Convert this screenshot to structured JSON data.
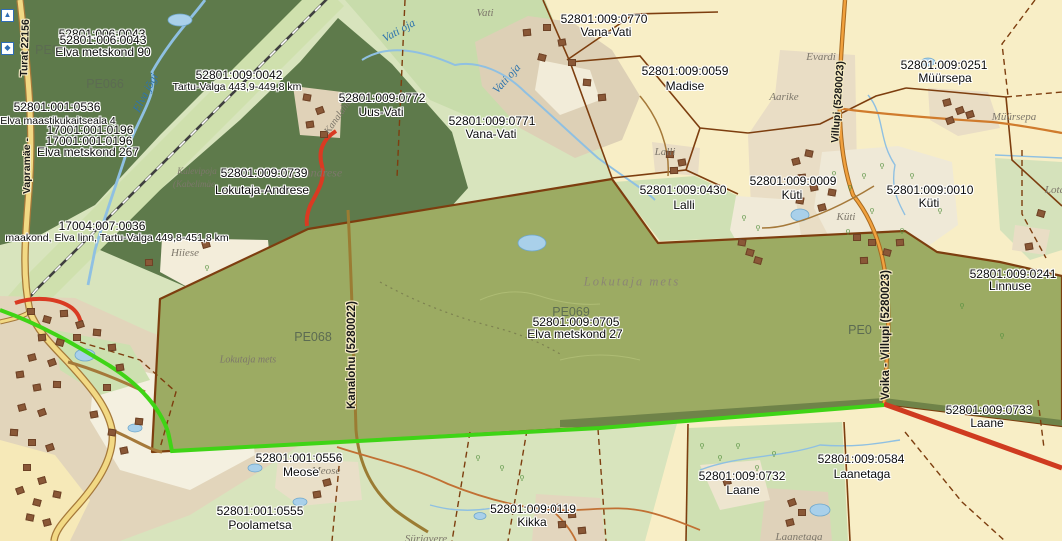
{
  "map_type": "cadastral-map-viewer",
  "colors": {
    "field_yellow": "#f8eec6",
    "grass_green": "#d8e4bd",
    "forest_dark": "#5e7a4b",
    "parcel_olive": "#9cab63",
    "boundary_brown": "#7d3e0f",
    "route_green": "#3fd416",
    "route_red": "#d93a22",
    "road_orange": "#f1a13e",
    "water_blue": "#8fc0e2"
  },
  "parcels": [
    {
      "code": "52801:006:0043",
      "name": "Elva metskond 90"
    },
    {
      "code": "52801:001:0536",
      "name": "Elva maastikukaitseala 4"
    },
    {
      "code": "17001:001:0196",
      "name": "Elva metskond 267"
    },
    {
      "code": "52801:009:0042",
      "name": "Tartu-Valga 443,9-449,8 km"
    },
    {
      "code": "17004:007:0036",
      "name": "maakond, Elva linn, Tartu-Valga 449,8-451,8 km"
    },
    {
      "code": "52801:009:0739",
      "name": "Lokutaja-Andrese"
    },
    {
      "code": "52801:009:0772",
      "name": "Uus-Vati"
    },
    {
      "code": "52801:009:0771",
      "name": "Vana-Vati"
    },
    {
      "code": "52801:009:0770",
      "name": "Vana-Vati"
    },
    {
      "code": "52801:009:0059",
      "name": "Madise"
    },
    {
      "code": "52801:009:0251",
      "name": "Müürsepa"
    },
    {
      "code": "52801:009:0430",
      "name": "Lalli"
    },
    {
      "code": "52801:009:0009",
      "name": "Küti"
    },
    {
      "code": "52801:009:0010",
      "name": "Küti"
    },
    {
      "code": "52801:009:0241",
      "name": "Linnuse"
    },
    {
      "code": "52801:009:0705",
      "name": "Elva metskond 27"
    },
    {
      "code": "52801:001:0556",
      "name": "Meose"
    },
    {
      "code": "52801:001:0555",
      "name": "Poolametsa"
    },
    {
      "code": "52801:009:0119",
      "name": "Kikka"
    },
    {
      "code": "52801:009:0733",
      "name": "Laane"
    },
    {
      "code": "52801:009:0584",
      "name": "Laanetaga"
    },
    {
      "code": "52801:009:0732",
      "name": "Laane"
    }
  ],
  "forest_codes": {
    "pe066": "PE066",
    "pe068": "PE068",
    "pe069": "PE069",
    "pe0_right": "PE0",
    "pe_topleft": "PE0"
  },
  "roads": {
    "kanalohu": "Kanalohu (5280022)",
    "voika_villupi": "Voika - Villupi (5280023)",
    "villupi_top": "Villupi (5280023)",
    "vapramae_lower": "Vapramäe -",
    "vapramae_upper": "Turat 22156"
  },
  "places": {
    "vati": "Vati",
    "evardi": "Evardi",
    "aarike": "Aarike",
    "myyrsepa": "Müürsepa",
    "lalli": "Lalli",
    "kyti": "Küti",
    "hiiese": "Hiiese",
    "lokutaja_mets": "Lokutaja mets",
    "lokutaja_mets2": "Lokutaja mets",
    "meose_ghost": "Meose",
    "andrese_ghost": "Lokutaja Andrese",
    "kalevipoja": "Kalevipoja",
    "kabelimae": "(Kabelimäe",
    "laanetaga_it": "Laanetaga",
    "syrjavere": "Sürjavere",
    "lota": "Lota",
    "kanalahu": "Kanalahu"
  },
  "waters": {
    "elva_jogi": "Elva jõgi",
    "vati_oja": "Vati oja"
  }
}
